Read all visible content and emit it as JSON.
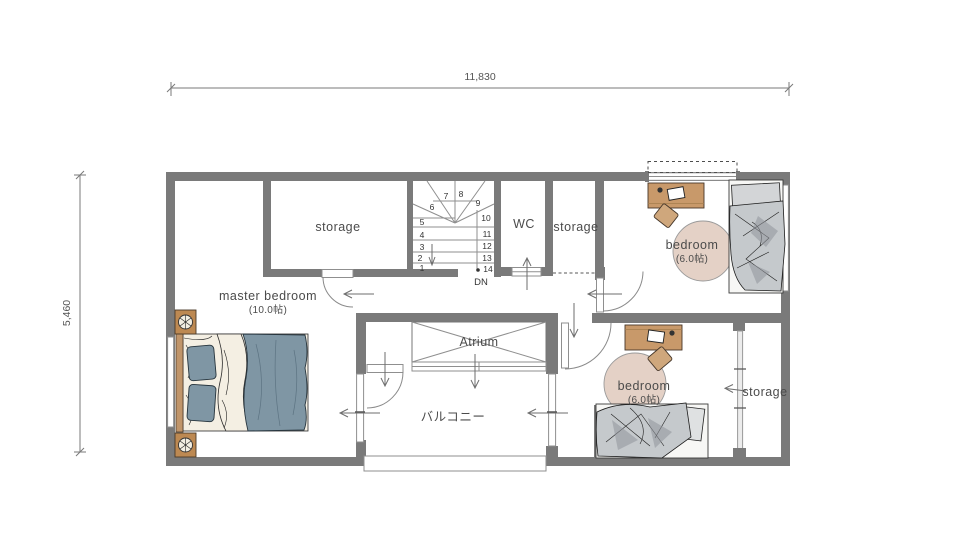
{
  "palette": {
    "wall": "#7a7a7a",
    "line": "#8f8f8f",
    "ink": "#4b4b4b",
    "desk": "#c8996a",
    "chair": "#cfa77c",
    "rug": "#e4d1c6",
    "nightstand": "#bd8952",
    "wood": "#c0956a",
    "sheet": "#f4efe3",
    "master_blanket": "#7f96a4",
    "kids_blanket": "#c5c9cc"
  },
  "dimensions": {
    "top": "11,830",
    "left": "5,460"
  },
  "rooms": {
    "master_bedroom": {
      "label": "master bedroom",
      "size": "(10.0帖)"
    },
    "storage_top_left": {
      "label": "storage"
    },
    "wc": {
      "label": "WC"
    },
    "storage_top_middle": {
      "label": "storage"
    },
    "bedroom_top_right": {
      "label": "bedroom",
      "size": "(6.0帖)"
    },
    "bedroom_bottom": {
      "label": "bedroom",
      "size": "(6.0帖)"
    },
    "storage_bottom_right": {
      "label": "storage"
    },
    "atrium": {
      "label": "Atrium"
    },
    "balcony": {
      "label": "バルコニー"
    }
  },
  "stairs": {
    "steps": [
      "1",
      "2",
      "3",
      "4",
      "5",
      "6",
      "7",
      "8",
      "9",
      "10",
      "11",
      "12",
      "13",
      "14"
    ],
    "down_label": "DN"
  }
}
